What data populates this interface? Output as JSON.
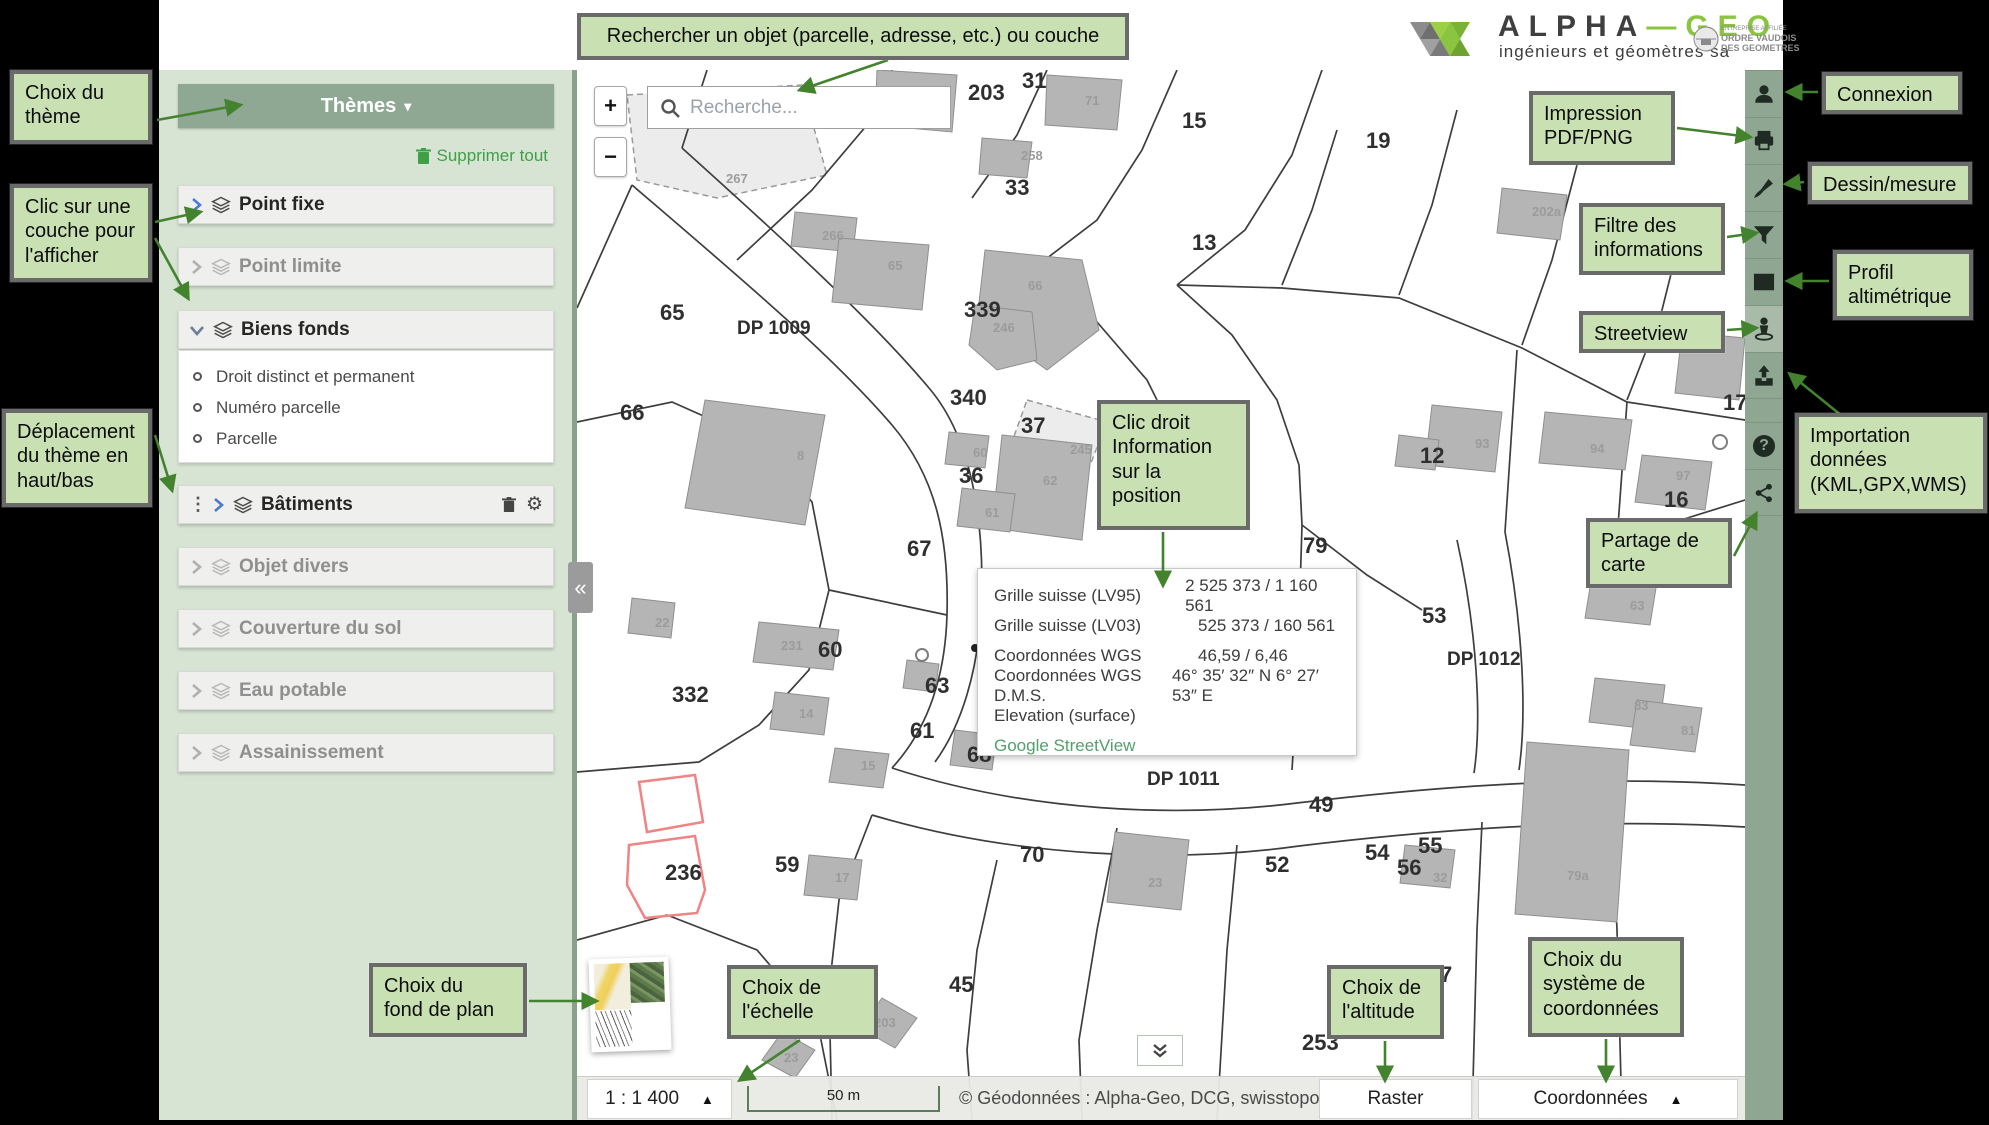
{
  "header": {
    "alpha": "ALPHA",
    "dash": "—",
    "geo": "GEO",
    "tagline": "ingénieurs et géomètres sa",
    "badge_line1": "ENTREPRISE AFFILIÉE",
    "badge_line2": "ORDRE VAUDOIS",
    "badge_line3": "DES GEOMETRES"
  },
  "sidebar": {
    "themes_button": "Thèmes",
    "themes_caret": "▾",
    "clear_all": "Supprimer tout",
    "layers": [
      {
        "label": "Point fixe",
        "state": "active"
      },
      {
        "label": "Point limite",
        "state": "inactive"
      },
      {
        "label": "Biens fonds",
        "state": "active",
        "expanded": true,
        "children": [
          "Droit distinct et permanent",
          "Numéro parcelle",
          "Parcelle"
        ]
      },
      {
        "label": "Bâtiments",
        "state": "active",
        "draggable": true,
        "actions": [
          "trash-icon",
          "gear-icon"
        ]
      },
      {
        "label": "Objet divers",
        "state": "inactive"
      },
      {
        "label": "Couverture du sol",
        "state": "inactive"
      },
      {
        "label": "Eau potable",
        "state": "inactive"
      },
      {
        "label": "Assainissement",
        "state": "inactive"
      }
    ]
  },
  "map": {
    "search_placeholder": "Recherche...",
    "zoom_in": "+",
    "zoom_out": "−",
    "collapse_sidebar": "«",
    "popup": {
      "rows": [
        {
          "label": "Grille suisse (LV95)",
          "value": "2 525 373 / 1 160 561"
        },
        {
          "label": "Grille suisse (LV03)",
          "value": "525 373 / 160 561"
        },
        {
          "label": "Coordonnées WGS",
          "value": "46,59 / 6,46"
        },
        {
          "label": "Coordonnées WGS D.M.S.",
          "value": "46° 35′ 32″ N 6° 27′ 53″ E"
        },
        {
          "label": "Elevation (surface)",
          "value": ""
        }
      ],
      "link": "Google StreetView"
    },
    "labels": [
      {
        "t": "347",
        "x": 226,
        "y": 50,
        "k": "p"
      },
      {
        "t": "230a",
        "x": 330,
        "y": 28,
        "k": "b"
      },
      {
        "t": "203",
        "x": 391,
        "y": 30,
        "k": "p"
      },
      {
        "t": "31",
        "x": 445,
        "y": 18,
        "k": "p"
      },
      {
        "t": "71",
        "x": 508,
        "y": 35,
        "k": "b"
      },
      {
        "t": "15",
        "x": 605,
        "y": 58,
        "k": "p"
      },
      {
        "t": "19",
        "x": 789,
        "y": 78,
        "k": "p"
      },
      {
        "t": "258",
        "x": 444,
        "y": 90,
        "k": "b"
      },
      {
        "t": "267",
        "x": 149,
        "y": 113,
        "k": "b"
      },
      {
        "t": "202a",
        "x": 955,
        "y": 146,
        "k": "b"
      },
      {
        "t": "266",
        "x": 245,
        "y": 170,
        "k": "b"
      },
      {
        "t": "33",
        "x": 428,
        "y": 125,
        "k": "p"
      },
      {
        "t": "13",
        "x": 615,
        "y": 180,
        "k": "p"
      },
      {
        "t": "65",
        "x": 83,
        "y": 250,
        "k": "p"
      },
      {
        "t": "65",
        "x": 311,
        "y": 200,
        "k": "b"
      },
      {
        "t": "DP 1009",
        "x": 160,
        "y": 264,
        "k": "r"
      },
      {
        "t": "339",
        "x": 387,
        "y": 247,
        "k": "p"
      },
      {
        "t": "246",
        "x": 416,
        "y": 262,
        "k": "b"
      },
      {
        "t": "66",
        "x": 43,
        "y": 350,
        "k": "p"
      },
      {
        "t": "66",
        "x": 451,
        "y": 220,
        "k": "b"
      },
      {
        "t": "340",
        "x": 373,
        "y": 335,
        "k": "p"
      },
      {
        "t": "37",
        "x": 444,
        "y": 363,
        "k": "p"
      },
      {
        "t": "36",
        "x": 382,
        "y": 413,
        "k": "p"
      },
      {
        "t": "60",
        "x": 396,
        "y": 387,
        "k": "b"
      },
      {
        "t": "62",
        "x": 466,
        "y": 415,
        "k": "b"
      },
      {
        "t": "8",
        "x": 220,
        "y": 390,
        "k": "b"
      },
      {
        "t": "61",
        "x": 408,
        "y": 447,
        "k": "b"
      },
      {
        "t": "245",
        "x": 493,
        "y": 384,
        "k": "b"
      },
      {
        "t": "67",
        "x": 330,
        "y": 486,
        "k": "p"
      },
      {
        "t": "79",
        "x": 726,
        "y": 483,
        "k": "p"
      },
      {
        "t": "12",
        "x": 843,
        "y": 393,
        "k": "p"
      },
      {
        "t": "93",
        "x": 898,
        "y": 378,
        "k": "b"
      },
      {
        "t": "94",
        "x": 1013,
        "y": 383,
        "k": "b"
      },
      {
        "t": "17",
        "x": 1146,
        "y": 340,
        "k": "p"
      },
      {
        "t": "97",
        "x": 1099,
        "y": 410,
        "k": "b"
      },
      {
        "t": "16",
        "x": 1087,
        "y": 437,
        "k": "p"
      },
      {
        "t": "53",
        "x": 845,
        "y": 553,
        "k": "p"
      },
      {
        "t": "DP 1012",
        "x": 870,
        "y": 595,
        "k": "r"
      },
      {
        "t": "63",
        "x": 1053,
        "y": 540,
        "k": "b"
      },
      {
        "t": "83",
        "x": 1057,
        "y": 640,
        "k": "b"
      },
      {
        "t": "81",
        "x": 1104,
        "y": 665,
        "k": "b"
      },
      {
        "t": "22",
        "x": 78,
        "y": 557,
        "k": "b"
      },
      {
        "t": "231",
        "x": 204,
        "y": 580,
        "k": "b"
      },
      {
        "t": "60",
        "x": 241,
        "y": 587,
        "k": "p"
      },
      {
        "t": "332",
        "x": 95,
        "y": 632,
        "k": "p"
      },
      {
        "t": "63",
        "x": 348,
        "y": 623,
        "k": "p"
      },
      {
        "t": "14",
        "x": 222,
        "y": 648,
        "k": "b"
      },
      {
        "t": "61",
        "x": 333,
        "y": 668,
        "k": "p"
      },
      {
        "t": "15",
        "x": 284,
        "y": 700,
        "k": "b"
      },
      {
        "t": "68",
        "x": 390,
        "y": 692,
        "k": "p"
      },
      {
        "t": "DP 1011",
        "x": 570,
        "y": 715,
        "k": "r"
      },
      {
        "t": "49",
        "x": 732,
        "y": 742,
        "k": "p"
      },
      {
        "t": "236",
        "x": 88,
        "y": 810,
        "k": "p"
      },
      {
        "t": "59",
        "x": 198,
        "y": 802,
        "k": "p"
      },
      {
        "t": "17",
        "x": 258,
        "y": 812,
        "k": "b"
      },
      {
        "t": "70",
        "x": 443,
        "y": 792,
        "k": "p"
      },
      {
        "t": "23",
        "x": 571,
        "y": 817,
        "k": "b"
      },
      {
        "t": "52",
        "x": 688,
        "y": 802,
        "k": "p"
      },
      {
        "t": "54",
        "x": 788,
        "y": 790,
        "k": "p"
      },
      {
        "t": "55",
        "x": 841,
        "y": 783,
        "k": "p"
      },
      {
        "t": "56",
        "x": 820,
        "y": 805,
        "k": "p"
      },
      {
        "t": "32",
        "x": 856,
        "y": 812,
        "k": "b"
      },
      {
        "t": "79a",
        "x": 990,
        "y": 810,
        "k": "b"
      },
      {
        "t": "45",
        "x": 372,
        "y": 922,
        "k": "p"
      },
      {
        "t": "7",
        "x": 863,
        "y": 912,
        "k": "p"
      },
      {
        "t": "203",
        "x": 297,
        "y": 957,
        "k": "b"
      },
      {
        "t": "23",
        "x": 207,
        "y": 992,
        "k": "b"
      },
      {
        "t": "253",
        "x": 725,
        "y": 980,
        "k": "p"
      }
    ]
  },
  "toolbar": {
    "items": [
      {
        "icon": "user-icon"
      },
      {
        "icon": "print-icon"
      },
      {
        "icon": "brush-icon"
      },
      {
        "icon": "filter-icon"
      },
      {
        "icon": "elevation-profile-icon"
      },
      {
        "icon": "streetview-icon"
      },
      {
        "icon": "upload-icon"
      },
      {
        "icon": "help-icon"
      },
      {
        "icon": "share-icon"
      }
    ]
  },
  "bottombar": {
    "scale": "1 : 1 400",
    "scale_caret": "▲",
    "scalebar": "50 m",
    "attribution": "© Géodonnées : Alpha-Geo, DCG, swisstopo, OSM",
    "basemap_mode": "Raster",
    "coords_mode": "Coordonnées",
    "coords_caret": "▲"
  },
  "annotations": [
    {
      "id": "choix-theme",
      "text": "Choix du\nthème"
    },
    {
      "id": "clic-couche",
      "text": "Clic sur une\ncouche pour\nl'afficher"
    },
    {
      "id": "deplacement-theme",
      "text": "Déplacement\ndu thème en\nhaut/bas"
    },
    {
      "id": "recherche",
      "text": "Rechercher un objet (parcelle, adresse, etc.) ou couche"
    },
    {
      "id": "connexion",
      "text": "Connexion"
    },
    {
      "id": "impression",
      "text": "Impression\nPDF/PNG"
    },
    {
      "id": "dessin-mesure",
      "text": "Dessin/mesure"
    },
    {
      "id": "filtre",
      "text": "Filtre des\ninformations"
    },
    {
      "id": "profil",
      "text": "Profil\naltimétrique"
    },
    {
      "id": "streetview",
      "text": "Streetview"
    },
    {
      "id": "importation",
      "text": "Importation\ndonnées\n(KML,GPX,WMS)"
    },
    {
      "id": "partage",
      "text": "Partage de\ncarte"
    },
    {
      "id": "clic-droit",
      "text": "Clic droit\nInformation\nsur la\nposition"
    },
    {
      "id": "fond-de-plan",
      "text": "Choix du\nfond de plan"
    },
    {
      "id": "echelle",
      "text": "Choix de\nl'échelle"
    },
    {
      "id": "altitude",
      "text": "Choix de\nl'altitude"
    },
    {
      "id": "systeme-coordonnees",
      "text": "Choix du\nsystème de\ncoordonnées"
    }
  ],
  "colors": {
    "callout_bg": "#c9e0b3",
    "callout_border": "#6a6a6a",
    "arrow_green": "#43832e",
    "sidebar_bg": "#d7e4d4",
    "themes_bar": "#8ea893",
    "toolbar_bg": "#8fa692",
    "brand_green": "#8bc53f",
    "link_green": "#52a06a",
    "action_green": "#3fa048",
    "map_highlight_red": "#ee8484"
  }
}
